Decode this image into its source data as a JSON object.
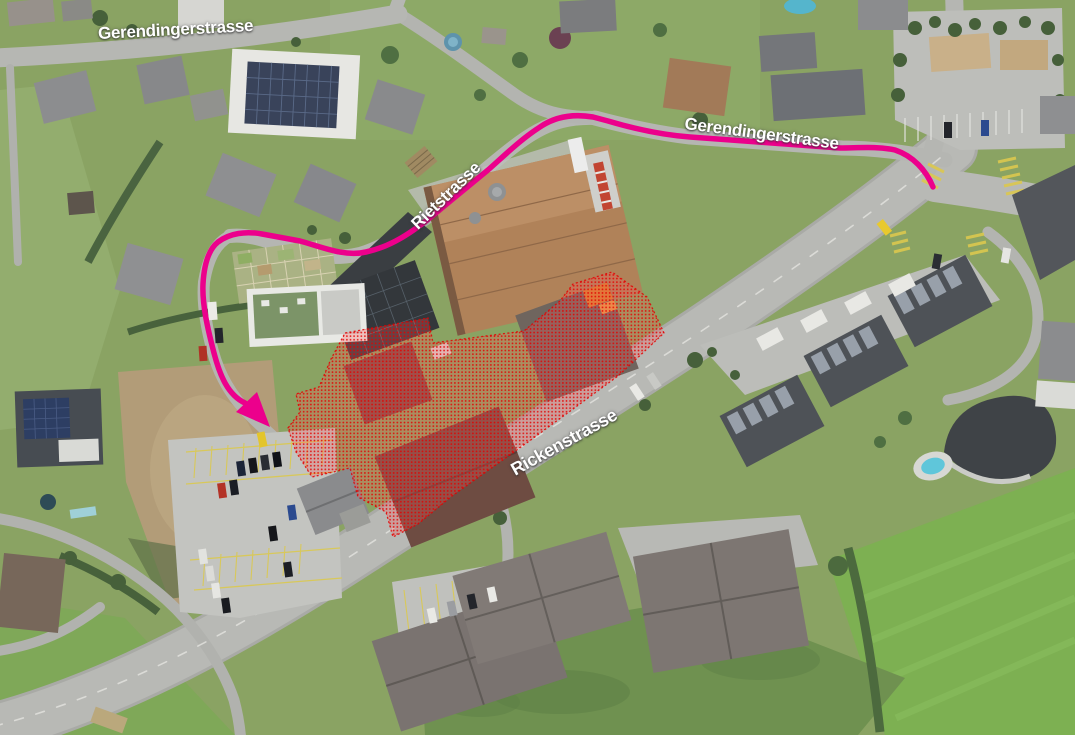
{
  "map": {
    "street_labels": [
      {
        "text": "Gerendingerstrasse"
      },
      {
        "text": "Gerendingerstrasse"
      },
      {
        "text": "Rietstrasse"
      },
      {
        "text": "Rickenstrasse"
      }
    ],
    "route_color": "#ec008c",
    "highlight_color": "#e30000"
  }
}
